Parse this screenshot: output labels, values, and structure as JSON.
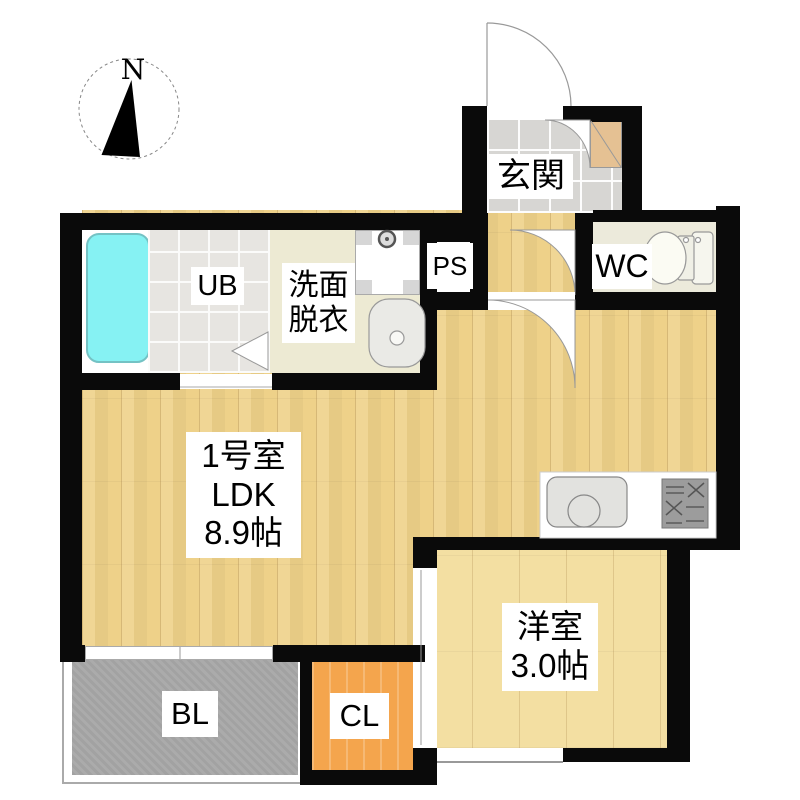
{
  "floorplan": {
    "compass": {
      "label": "N"
    },
    "rooms": {
      "entrance": {
        "label": "玄関"
      },
      "toilet": {
        "label": "WC"
      },
      "pipe_space": {
        "label": "PS"
      },
      "unit_bath": {
        "label": "UB"
      },
      "washroom": {
        "line1": "洗面",
        "line2": "脱衣"
      },
      "ldk": {
        "line1": "1号室",
        "line2": "LDK",
        "line3": "8.9帖"
      },
      "western_room": {
        "line1": "洋室",
        "line2": "3.0帖"
      },
      "balcony": {
        "label": "BL"
      },
      "closet": {
        "label": "CL"
      }
    },
    "colors": {
      "wall": "#0a0a0a",
      "wood": "#eed189",
      "wood-light": "#f3dfa2",
      "tile-entrance": "#d7d6d3",
      "tile-bath": "#e7e5e1",
      "floor-wc": "#eceadb",
      "floor-washroom": "#edead3",
      "closet": "#f4a54d",
      "balcony": "#ababab",
      "bathtub": "#86f2f3",
      "shoebox": "#e5c193"
    }
  }
}
